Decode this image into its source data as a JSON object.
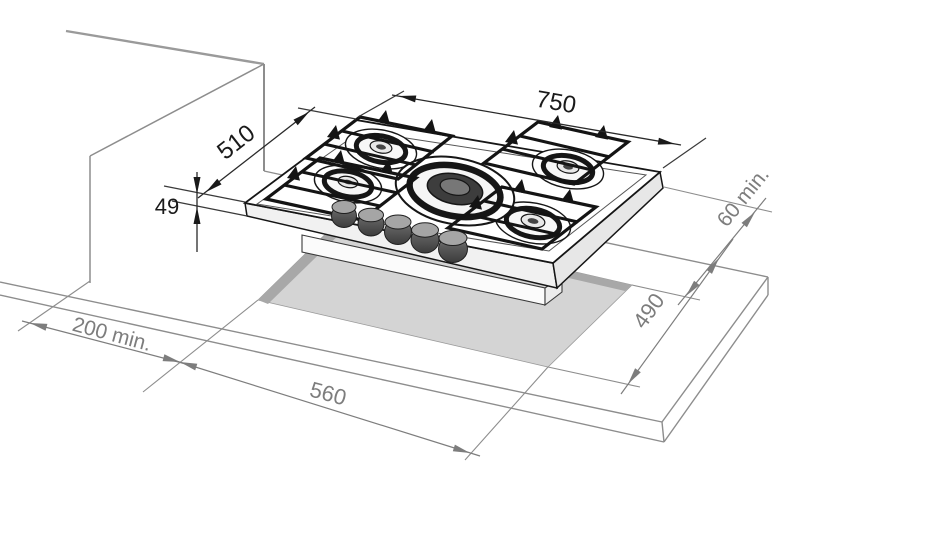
{
  "diagram": {
    "type": "installation-drawing",
    "subject": "built-in 5-burner gas hob with worktop cutout",
    "units_implied": "mm",
    "burner_count": 5,
    "knob_count": 5,
    "dimensions": {
      "hob_width": {
        "label": "750",
        "meaning": "hob overall width"
      },
      "hob_depth": {
        "label": "510",
        "meaning": "hob overall depth"
      },
      "hob_height": {
        "label": "49",
        "meaning": "hob body height below worktop"
      },
      "side_clearance": {
        "label": "200 min.",
        "meaning": "minimum clearance to side wall"
      },
      "cutout_width": {
        "label": "560",
        "meaning": "worktop cutout width"
      },
      "cutout_depth": {
        "label": "490",
        "meaning": "worktop cutout depth"
      },
      "rear_clearance": {
        "label": "60 min.",
        "meaning": "minimum clearance behind cutout"
      }
    },
    "colors": {
      "dimension_primary": "#1a1a1a",
      "dimension_secondary": "#7d7d7d",
      "construction_gray": "#8d8d8d",
      "cutout_fill": "#d4d4d4",
      "cutout_shadow": "#a8a8a8",
      "hob_line": "#161616",
      "background": "#ffffff"
    }
  }
}
